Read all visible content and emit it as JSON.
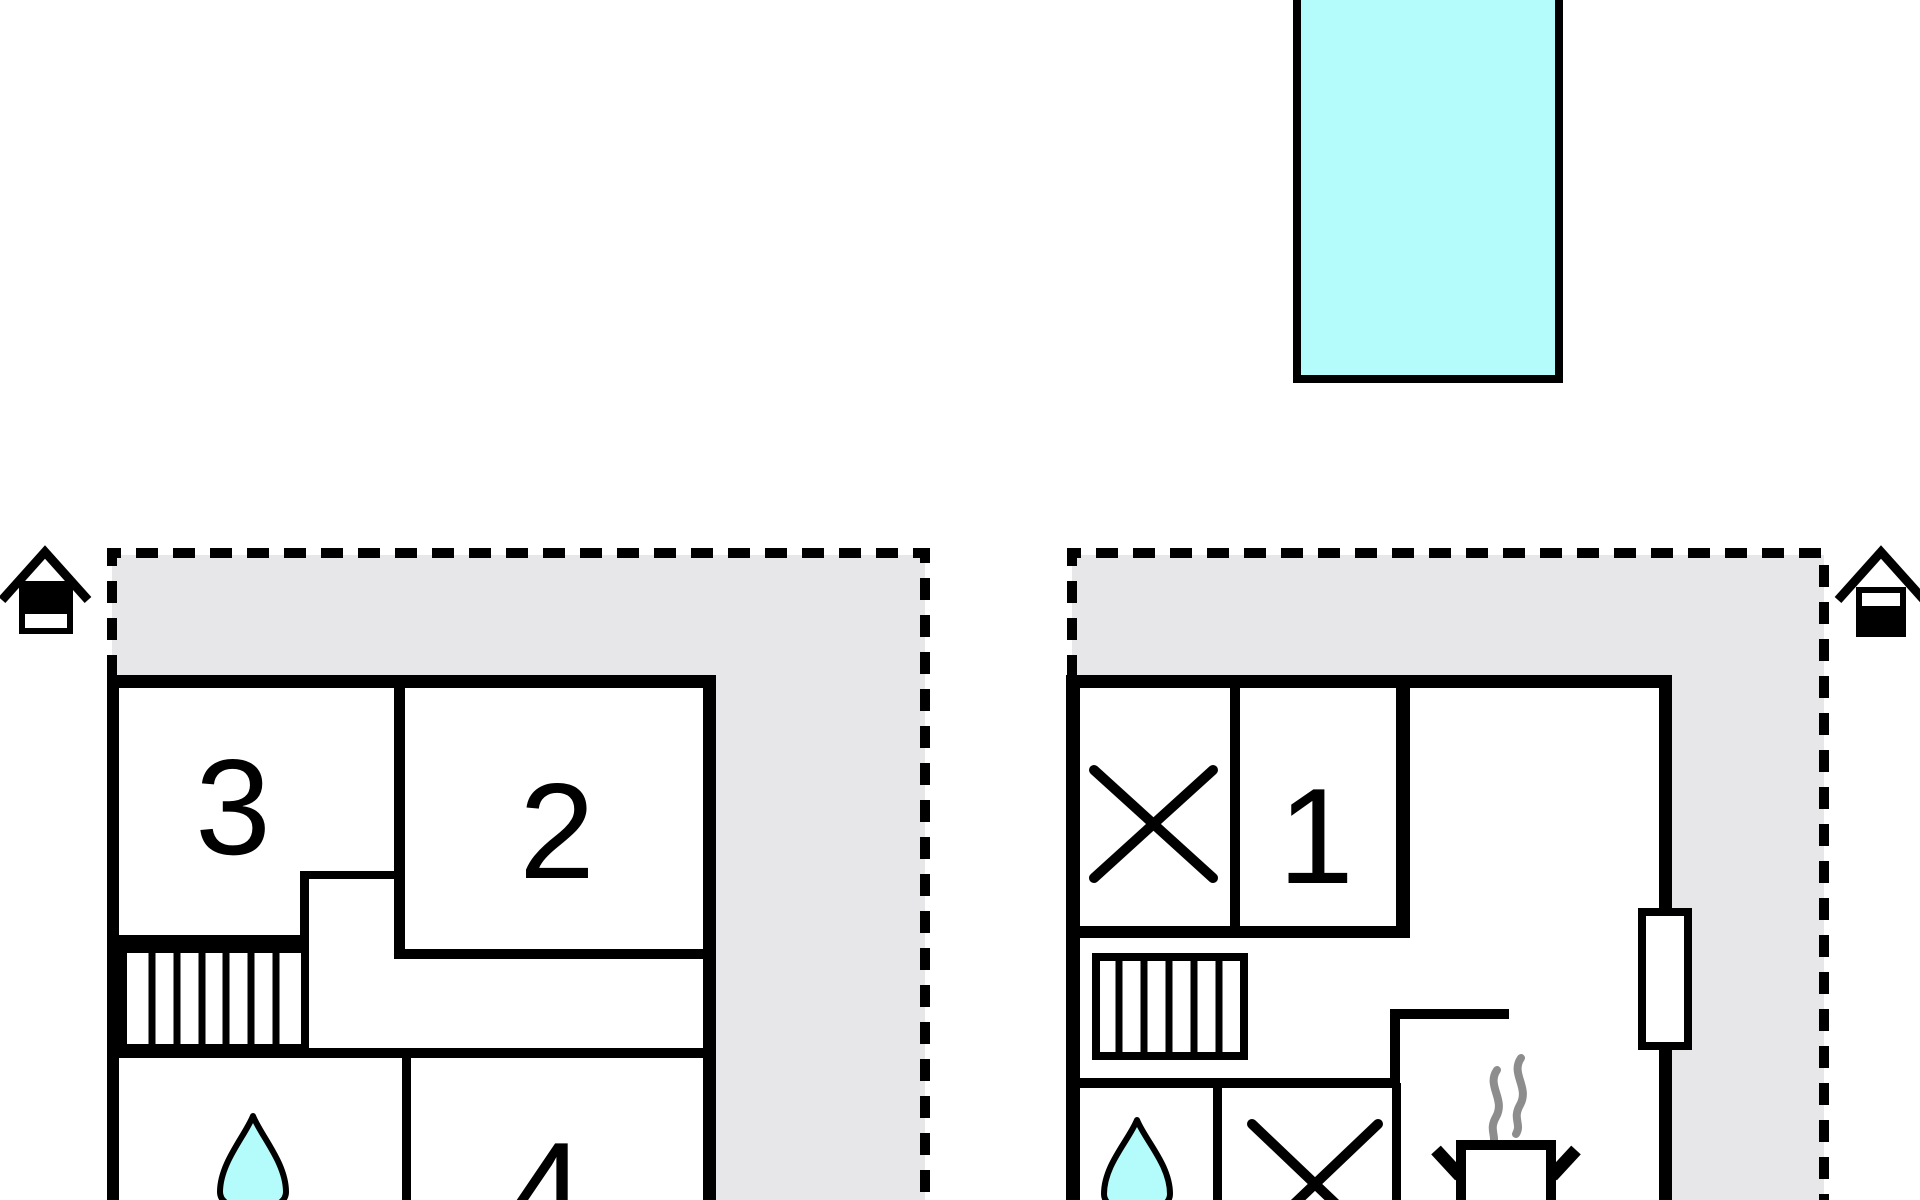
{
  "figure": {
    "type": "holiday-home-floor-plan",
    "floor_count": 2,
    "cut_off": "bottom edge of drawing is cropped at the image bottom"
  },
  "colors": {
    "line": "#000000",
    "terrace_fill": "#e7e7ea",
    "pool_fill": "#b4fbfb",
    "water_drop_fill": "#b4fbfb",
    "steam": "#8d8d8d",
    "paper": "#ffffff"
  },
  "labels": {
    "room1": "1",
    "room2": "2",
    "room3": "3",
    "room4": "4"
  },
  "icons": {
    "pool": "pool",
    "left_house": "house-with-chimney-icon",
    "right_house": "house-with-chimney-icon",
    "stairs": "stairs",
    "water_drop": "water-drop-icon",
    "cross": "x-mark",
    "stove": "steaming-pot-icon",
    "window": "window-opening"
  }
}
